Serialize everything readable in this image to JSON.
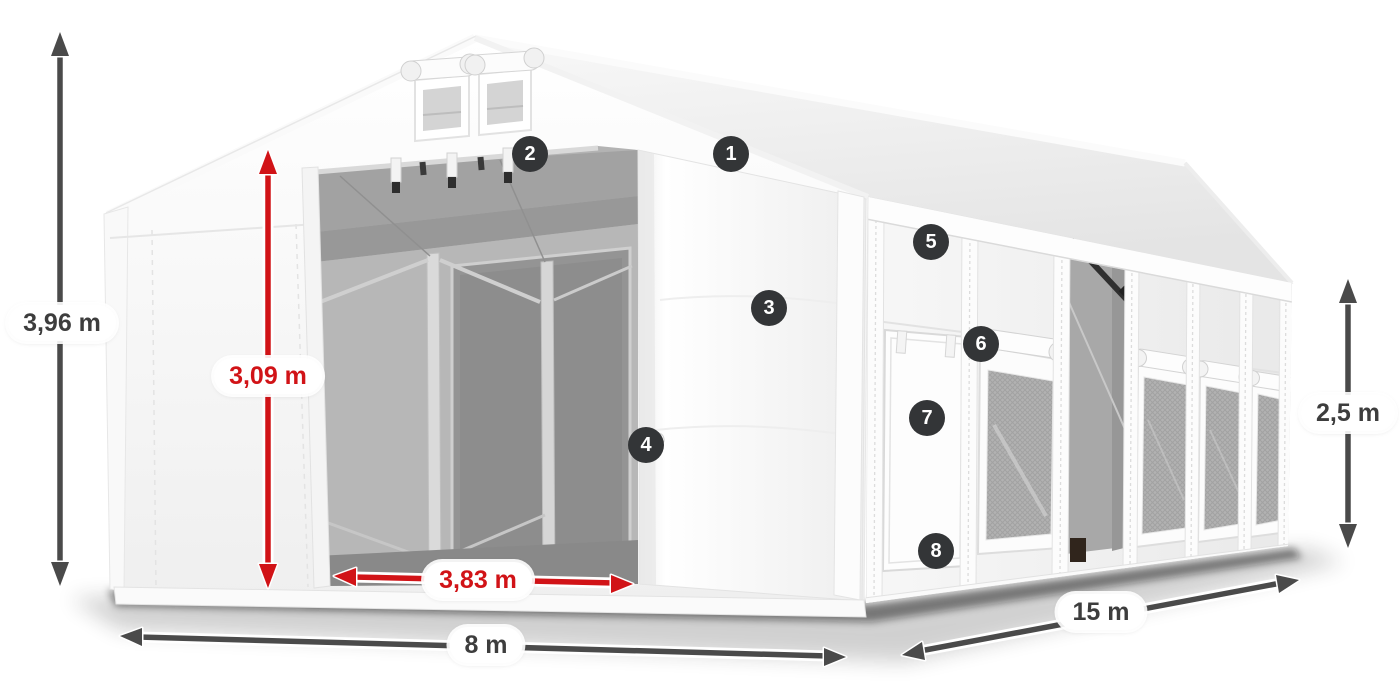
{
  "theme": {
    "background": "#ffffff",
    "accent-red": "#d11317",
    "arrow-dark": "#4a4a4a",
    "text-dark": "#3d3d3d",
    "badge-bg": "#333537",
    "badge-text": "#ffffff"
  },
  "dimensions": {
    "total_height": {
      "label": "3,96 m",
      "style": "dark"
    },
    "door_height": {
      "label": "3,09 m",
      "style": "red"
    },
    "door_width": {
      "label": "3,83 m",
      "style": "red"
    },
    "front_width": {
      "label": "8 m",
      "style": "dark"
    },
    "side_length": {
      "label": "15 m",
      "style": "dark"
    },
    "side_height": {
      "label": "2,5 m",
      "style": "dark"
    }
  },
  "callouts": [
    "1",
    "2",
    "3",
    "4",
    "5",
    "6",
    "7",
    "8"
  ]
}
